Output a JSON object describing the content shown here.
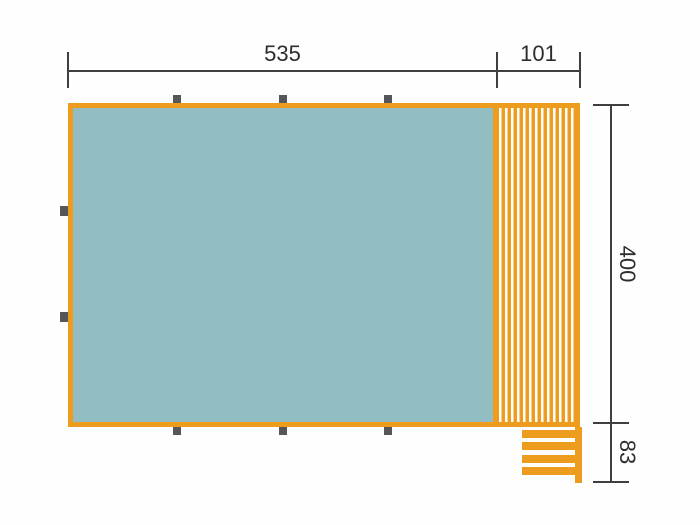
{
  "diagram": {
    "type": "technical-plan-top-view",
    "description": "Top-view plan of a structure with blue interior, slatted deck strip on the right and steps at the bottom right, annotated with dimension lines",
    "labels": {
      "main_width": "535",
      "deck_width": "101",
      "main_height": "400",
      "steps_height": "83"
    },
    "colors": {
      "outline_orange": "#ED9C1E",
      "fill_blue": "#92BDC2",
      "marker_gray": "#55565A",
      "dimension_line": "#3F3F3F",
      "label_text": "#2D2D2D",
      "background": "#FEFEFE"
    },
    "markers": {
      "shape": "square",
      "count_top": 3,
      "count_bottom": 3,
      "count_left": 2
    },
    "steps": {
      "bar_count": 4
    }
  }
}
